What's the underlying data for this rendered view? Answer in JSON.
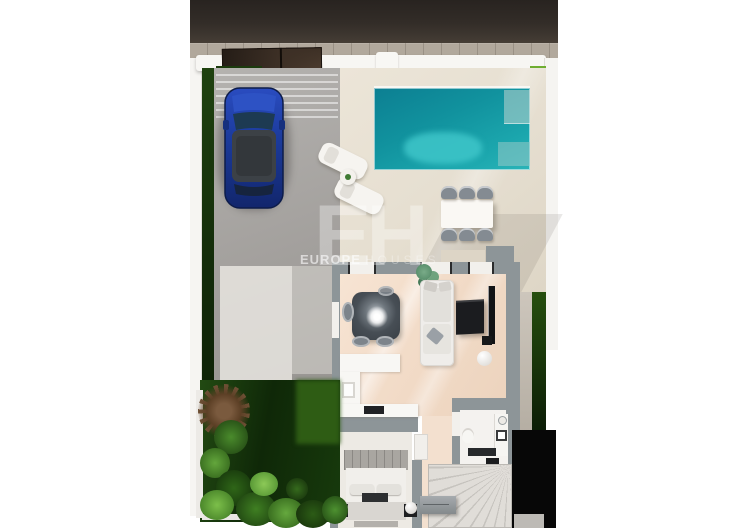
{
  "image": {
    "type": "3d-top-down-floor-plan-render",
    "description": "Photorealistic aerial render of a villa plot: street and sidewalk at top, walled plot with entrance gate, blue car on grey driveway, turquoise pool on beige terrace with two sun loungers and a six-seat dining set, furnished ground floor (living room, kitchen, bedroom, bathroom, winder staircase) and a planted garden at the lower left"
  },
  "watermark": {
    "monogram": "EH",
    "brand": "EUROPE",
    "brand_suffix": "HOUSES"
  },
  "palette": {
    "background": "#ffffff",
    "road_dark": "#2e2823",
    "sidewalk_beige": "#b1a89c",
    "wall_white": "#f7f6f3",
    "gate_brown": "#3a2d22",
    "hedge_dark_green": "#16350c",
    "grass_green": "#55941f",
    "lawn_dark_green": "#143009",
    "driveway_grey": "#a7a5a2",
    "terrace_beige": "#e6dfd1",
    "pool_teal": "#149aa6",
    "pool_light_teal": "#3ec6c9",
    "car_blue": "#1d3f9f",
    "house_wall_grey": "#8d9598",
    "wood_floor": "#f2dcc9",
    "furniture_black": "#1b1c1f",
    "watermark_white": "#ffffff"
  },
  "scene": {
    "objects": [
      "road",
      "sidewalk",
      "perimeter-wall",
      "entrance-gate",
      "hedge",
      "driveway",
      "car",
      "swimming-pool",
      "pool-steps",
      "sun-lounger",
      "side-table",
      "outdoor-dining-table",
      "outdoor-chair",
      "terrace",
      "lawn",
      "garden-bush",
      "palm-plant",
      "living-room",
      "dining-table",
      "ceiling-light-glare",
      "sofa",
      "tv-cabinet",
      "tv",
      "floor-lamp",
      "kitchen-counter",
      "sink",
      "cooktop",
      "bed",
      "nightstand",
      "bedside-lamp",
      "bathroom",
      "vanity",
      "toilet",
      "shower",
      "staircase",
      "sideboard"
    ]
  }
}
